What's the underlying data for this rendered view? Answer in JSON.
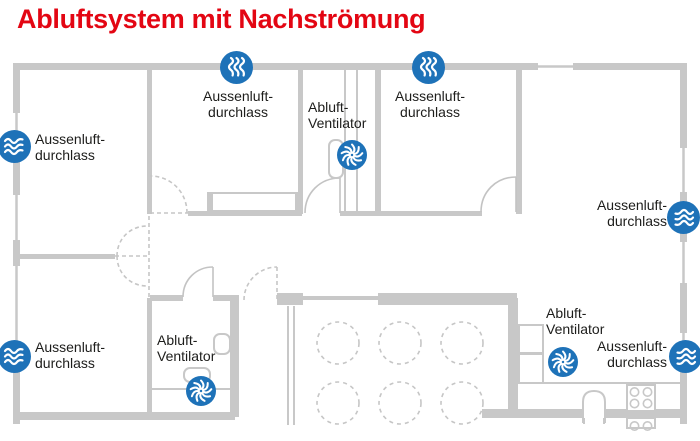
{
  "title": "Abluftsystem mit Nachströmung",
  "colors": {
    "accent_red": "#e30613",
    "icon_blue": "#1e72b8",
    "wall_gray": "#c8c8c8",
    "text_dark": "#1d1d1b"
  },
  "labels": {
    "outdoor_left_top": "Aussenluft-\ndurchlass",
    "outdoor_top_1": "Aussenluft-\ndurchlass",
    "outdoor_top_2": "Aussenluft-\ndurchlass",
    "outdoor_right_top": "Aussenluft-\ndurchlass",
    "outdoor_left_bottom": "Aussenluft-\ndurchlass",
    "outdoor_right_bottom": "Aussenluft-\ndurchlass",
    "fan_wc": "Abluft-\nVentilator",
    "fan_bath": "Abluft-\nVentilator",
    "fan_kitchen": "Abluft-\nVentilator"
  },
  "icons": {
    "outdoor_air_inlet_count": 6,
    "exhaust_fan_count": 3,
    "outdoor_air_icon": "air-inlet-icon",
    "exhaust_fan_icon": "exhaust-fan-icon"
  }
}
